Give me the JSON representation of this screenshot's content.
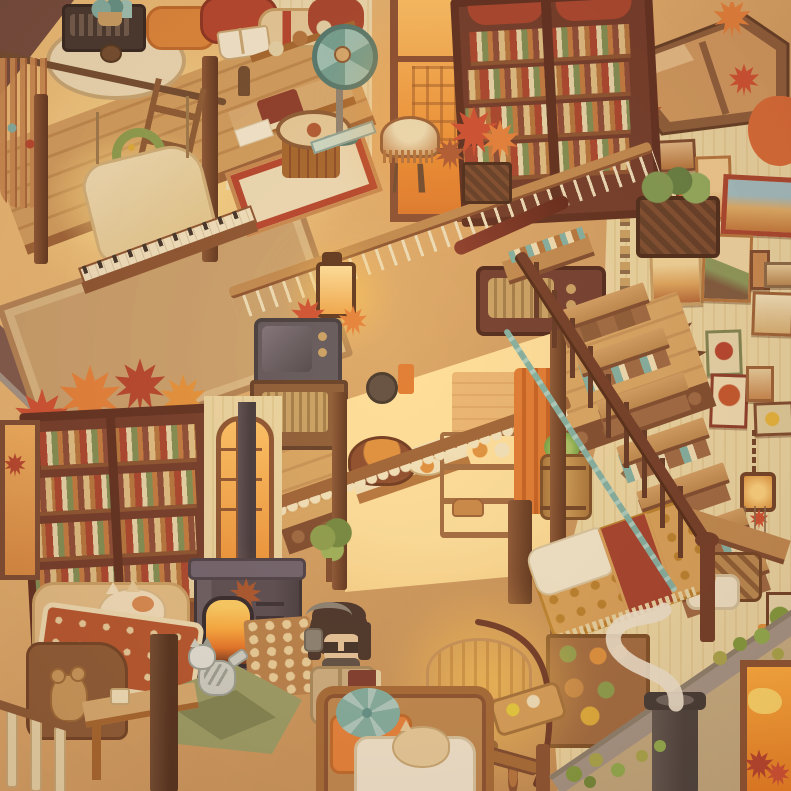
{
  "scene": {
    "description": "Isometric pixel-art cozy autumn loft interior, warm evening light, no on-screen text",
    "style": "cozy-autumn-pixel-room"
  },
  "palette": {
    "floor_tan": "#cf9c63",
    "wall_cream": "#ecd9a8",
    "wood_dark": "#6e4128",
    "wood_mid": "#a5662f",
    "wood_light": "#d9ae74",
    "shelf_frame": "#6e392b",
    "shelf_accent": "#a8432f",
    "glow_amber": "#ff9d3f",
    "glow_yellow": "#ffd884",
    "leaf_red": "#cf4f33",
    "leaf_orange": "#e6813c",
    "leaf_rust": "#b05a35",
    "leaf_brown": "#9c6840",
    "teal": "#7fb2a8",
    "teal_deep": "#5d948e",
    "stove_grey": "#544b55",
    "stove_dark": "#3c353e",
    "fire": "#ffb145",
    "rug_brown": "#a5754a",
    "rug_border": "#8a5c3a",
    "exterior_olive": "#c6b086",
    "roof_mauve": "#7d5a50",
    "roof_grey": "#a3968a",
    "quilt_gold": "#d8a35c",
    "quilt_red": "#a33f2e",
    "curtain_orange": "#e07a33",
    "smoke_white": "#efe8d6",
    "character_hair": "#44322c",
    "character_coat": "#cdb186",
    "character_jeans": "#7e99b2"
  },
  "objects": [
    {
      "name": "loft-bed",
      "desc": "canopy loft platform with pillows, open book, round table with boombox and mug"
    },
    {
      "name": "swing-bench",
      "desc": "hanging cushioned bench under loft with green wreath"
    },
    {
      "name": "armchair",
      "desc": "caramel armchair with orange tufted cushion, cream throw and ottoman"
    },
    {
      "name": "stool",
      "desc": "round wooden stool"
    },
    {
      "name": "desk",
      "desc": "work desk with papers, red box and wall shelf"
    },
    {
      "name": "standing-fan",
      "desc": "teal vintage standing fan"
    },
    {
      "name": "drum-table",
      "desc": "drum-shaped side table on patterned rug"
    },
    {
      "name": "fringe-lamp",
      "desc": "fringed parlor lamp in front of glowing window"
    },
    {
      "name": "tall-window",
      "desc": "large window with amber sunset glow"
    },
    {
      "name": "double-bookshelf",
      "desc": "tall dark bookshelf packed with colorful books"
    },
    {
      "name": "skylight",
      "desc": "wood-framed skylight with maple leaves on the glass"
    },
    {
      "name": "mezzanine-table",
      "desc": "long plank table with candle lantern, maple leaves, vintage radio and basket planter"
    },
    {
      "name": "keyboard-piano",
      "desc": "keyboard piano at the mezzanine railing"
    },
    {
      "name": "tv-cabinet",
      "desc": "retro TV on a speaker cabinet"
    },
    {
      "name": "gallery-wall",
      "desc": "many framed desert, cactus and flower prints"
    },
    {
      "name": "staircase",
      "desc": "wooden staircase with handrail, balusters and teal garland"
    },
    {
      "name": "kitchen-nook",
      "desc": "glowing alcove with counter, soup bowl, dish shelf, hanging pans and orange curtain"
    },
    {
      "name": "barrel-cabbage",
      "desc": "wooden barrel with a cabbage plant"
    },
    {
      "name": "under-stairs-bed",
      "desc": "bed with golden patterned quilt, white sheet and red runner"
    },
    {
      "name": "wood-stove",
      "desc": "black wood stove with glowing fire and stovepipe"
    },
    {
      "name": "firewood-stack",
      "desc": "stacked firewood logs"
    },
    {
      "name": "left-bookshelf",
      "desc": "dark bookshelf with maple leaves above"
    },
    {
      "name": "arched-window",
      "desc": "narrow arched window with warm glow"
    },
    {
      "name": "reading-couch",
      "desc": "couch with quilt, sleeping cream cat and teddy bear"
    },
    {
      "name": "kitten",
      "desc": "grey tabby kitten playing"
    },
    {
      "name": "character",
      "desc": "person with dark bob hair, headphones, glasses, tan coat, jeans, holding a book"
    },
    {
      "name": "balustrade-lamp",
      "desc": "glowing fringed table lamp behind turned-wood balustrade with food tray"
    },
    {
      "name": "pet-bed",
      "desc": "wicker pet bed with orange mattress, teal cushion, white blanket and cream cat"
    },
    {
      "name": "exterior-corner",
      "desc": "outside corner with chimney, curling smoke, ivy and glowing doorway"
    },
    {
      "name": "maple-leaves",
      "desc": "red and orange maple leaf clusters along rooflines"
    },
    {
      "name": "wall-chimes",
      "desc": "hanging bead chain and lantern wind chime on the right wall"
    }
  ]
}
